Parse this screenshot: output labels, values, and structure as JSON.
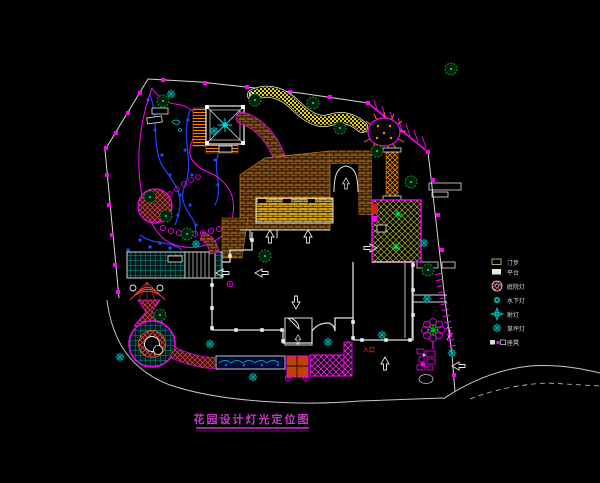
{
  "title_block": {
    "text": "花园设计灯光定位图"
  },
  "plan": {
    "entrance_label": "入口"
  },
  "legend": {
    "items": [
      {
        "icon": "stepping-stone-icon",
        "label": "汀步"
      },
      {
        "icon": "platform-icon",
        "label": "平台"
      },
      {
        "icon": "courtyard-lamp-icon",
        "label": "庭院灯"
      },
      {
        "icon": "underwater-lamp-icon",
        "label": "水下灯"
      },
      {
        "icon": "spot-lamp-icon",
        "label": "射灯"
      },
      {
        "icon": "lawn-lamp-icon",
        "label": "草坪灯"
      },
      {
        "icon": "bench-icon",
        "label": "座凳"
      }
    ]
  },
  "palette": {
    "background": "#000000",
    "boundary_magenta": "#FF00FF",
    "wall_white": "#E6E6E6",
    "water_blue": "#2244FF",
    "foliage_green": "#0FA00F",
    "fixture_teal": "#00B8B8",
    "brick_brown": "#9A5A14",
    "deck_yellow": "#D4A017",
    "path_yellow": "#E8D800",
    "title_magenta": "#C839C8",
    "entrance_red": "#E02020"
  }
}
